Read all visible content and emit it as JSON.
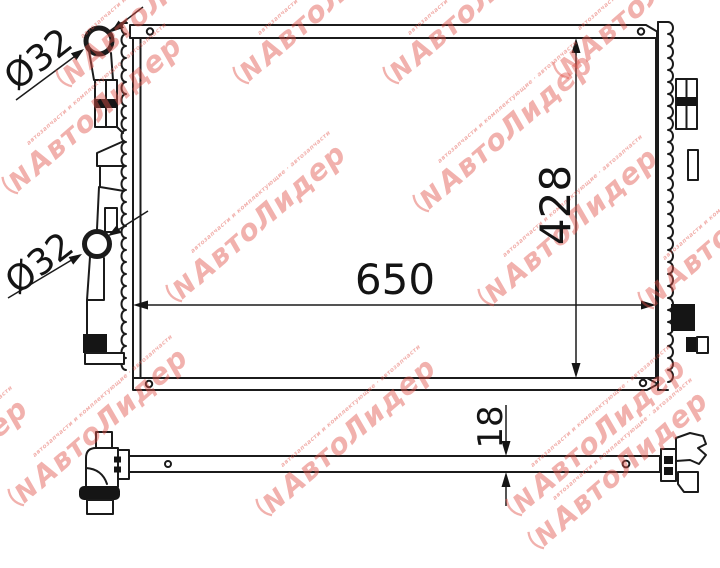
{
  "drawing": {
    "type": "radiator technical drawing, front view and bottom view",
    "line_color": "#1b1b1b",
    "dims": {
      "width": "650",
      "height": "428",
      "thickness": "18",
      "pipe_top": "Ø32",
      "pipe_bottom": "Ø32"
    }
  },
  "watermark": {
    "brand_text": "АвтоЛидер",
    "small_text": "автозапчасти и комплектующие · автозапчасти",
    "logo_letter": "N",
    "color": "#e2544b",
    "opacity": 0.45,
    "angle_deg": -41,
    "positions": [
      [
        -140,
        562
      ],
      [
        14,
        199
      ],
      [
        68,
        92
      ],
      [
        178,
        307
      ],
      [
        245,
        89
      ],
      [
        395,
        89
      ],
      [
        425,
        217
      ],
      [
        490,
        311
      ],
      [
        565,
        84
      ],
      [
        650,
        314
      ],
      [
        20,
        511
      ],
      [
        268,
        521
      ],
      [
        518,
        521
      ],
      [
        540,
        554
      ]
    ]
  }
}
